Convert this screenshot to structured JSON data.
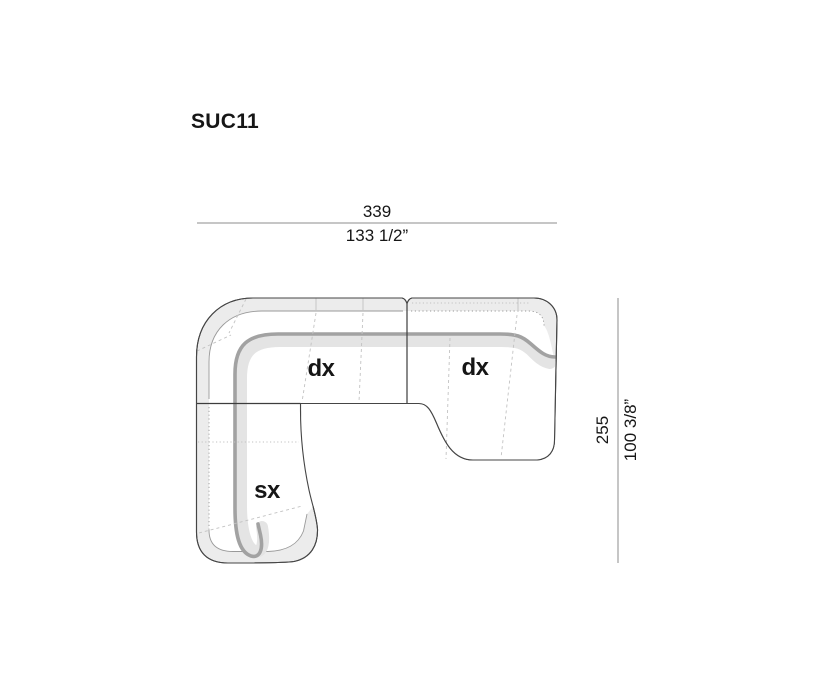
{
  "title": "SUC11",
  "diagram": {
    "kind": "sofa-sectional-top-view-technical-drawing",
    "sections": [
      {
        "id": "corner-seat",
        "label": "dx"
      },
      {
        "id": "right-chaise",
        "label": "dx"
      },
      {
        "id": "left-chaise",
        "label": "sx"
      }
    ],
    "dimensions": {
      "width": {
        "cm": "339",
        "inches": "133 1/2”"
      },
      "depth": {
        "cm": "255",
        "inches": "100 3/8”"
      }
    },
    "colors": {
      "background": "#ffffff",
      "outline": "#454545",
      "backrest_band": "#ececec",
      "fold_line": "#a2a2a2",
      "fold_shadow": "#e4e4e4",
      "seam": "#c2c2c2",
      "dimension_line": "#8e8e8e",
      "text": "#161616"
    }
  }
}
